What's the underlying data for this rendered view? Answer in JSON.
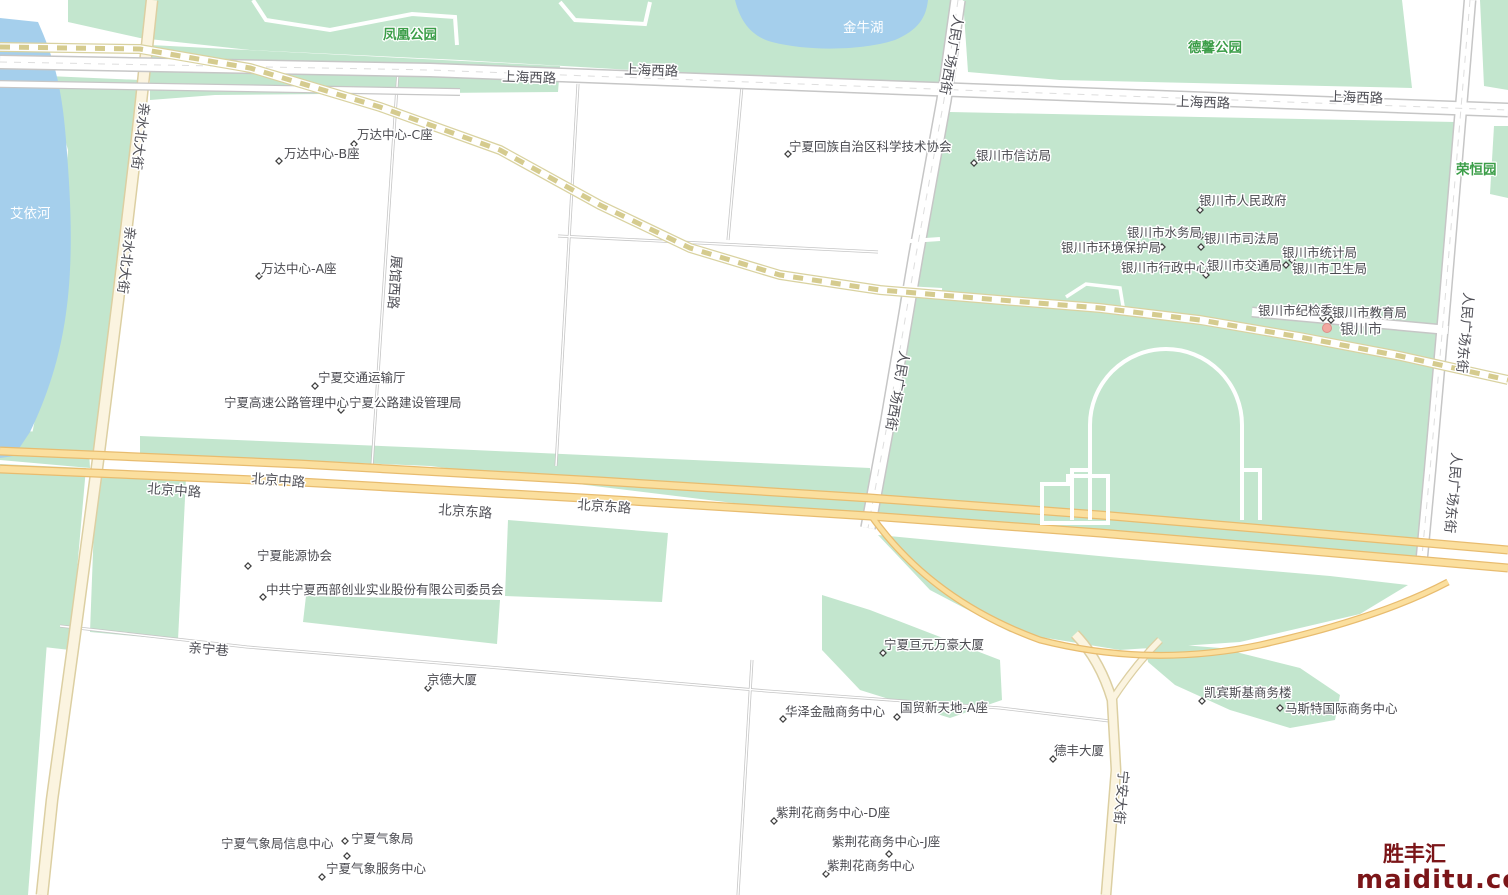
{
  "watermark": {
    "brand": "胜丰汇",
    "site": "maiditu.com",
    "color": "#7b1518"
  },
  "colors": {
    "water": "#a5cfec",
    "park_green": "#c3e6ce",
    "major_road_fill": "#fbdf9e",
    "major_road_casing": "#e8bc6f",
    "minor_road_fill": "#fbf4e0",
    "railway_dash": "#d5cb8e",
    "park_label": "#3c9e49",
    "poi_label": "#4a4a50",
    "city_dot": "#f2a8a0"
  },
  "labels": {
    "water": {
      "aiyi_river": "艾依河",
      "jinniu_lake": "金牛湖"
    },
    "parks": {
      "fenghuang": "凤凰公园",
      "dexin": "德馨公园",
      "rongheng": "荣恒园"
    },
    "roads": {
      "shanghai_west": "上海西路",
      "beijing_middle": "北京中路",
      "beijing_east": "北京东路",
      "qinshui_north": "亲水北大街",
      "zhanguan_west": "展馆西路",
      "renmin_square_west": "人民广场西街",
      "renmin_square_east": "人民广场东街",
      "ningan": "宁安大街",
      "qinning": "亲宁巷"
    },
    "city": {
      "yinchuan": "银川市"
    }
  },
  "pois": [
    {
      "label": "万达中心-C座"
    },
    {
      "label": "万达中心-B座"
    },
    {
      "label": "万达中心-A座"
    },
    {
      "label": "宁夏回族自治区科学技术协会"
    },
    {
      "label": "银川市信访局"
    },
    {
      "label": "银川市人民政府"
    },
    {
      "label": "银川市水务局"
    },
    {
      "label": "银川市司法局"
    },
    {
      "label": "银川市环境保护局"
    },
    {
      "label": "银川市行政中心"
    },
    {
      "label": "银川市交通局"
    },
    {
      "label": "银川市统计局"
    },
    {
      "label": "银川市卫生局"
    },
    {
      "label": "银川市纪检委"
    },
    {
      "label": "银川市教育局"
    },
    {
      "label": "宁夏交通运输厅"
    },
    {
      "label": "宁夏高速公路管理中心宁夏公路建设管理局"
    },
    {
      "label": "宁夏能源协会"
    },
    {
      "label": "中共宁夏西部创业实业股份有限公司委员会"
    },
    {
      "label": "宁夏亘元万豪大厦"
    },
    {
      "label": "京德大厦"
    },
    {
      "label": "华泽金融商务中心"
    },
    {
      "label": "国贸新天地-A座"
    },
    {
      "label": "凯宾斯基商务楼"
    },
    {
      "label": "马斯特国际商务中心"
    },
    {
      "label": "德丰大厦"
    },
    {
      "label": "紫荆花商务中心-D座"
    },
    {
      "label": "紫荆花商务中心-J座"
    },
    {
      "label": "紫荆花商务中心"
    },
    {
      "label": "宁夏气象局信息中心"
    },
    {
      "label": "宁夏气象局"
    },
    {
      "label": "宁夏气象服务中心"
    }
  ]
}
